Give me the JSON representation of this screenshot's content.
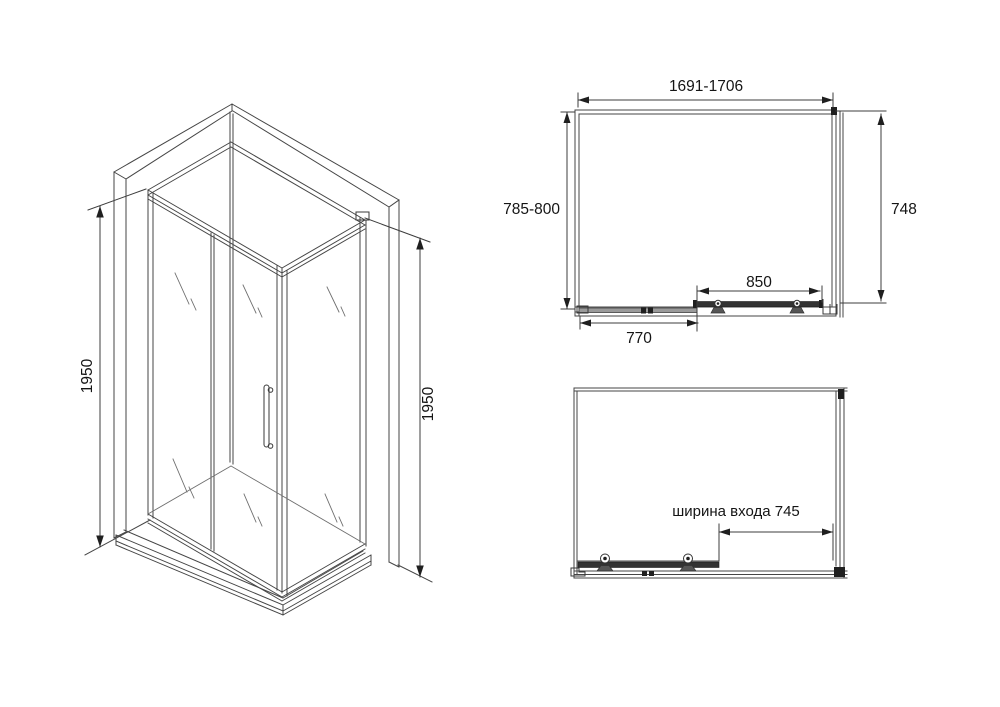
{
  "page": {
    "description": "Technical line drawing of a corner shower enclosure with sliding door: isometric view on the left, plan (top) view at upper right, front elevation at lower right",
    "background": "#ffffff"
  },
  "colors": {
    "line": "#454545",
    "line_light": "#6e6e6e",
    "dimension_line": "#3c3c3c",
    "fill_dark": "#1f1f1f",
    "fill_gray": "#9a9a9a",
    "text": "#151515",
    "background": "#ffffff"
  },
  "iso_view": {
    "label_height_left": "1950",
    "label_height_right": "1950"
  },
  "top_view": {
    "label_width_range": "1691-1706",
    "label_depth_range": "785-800",
    "label_side_panel_depth": "748",
    "label_door_width": "850",
    "label_fixed_panel_width": "770"
  },
  "front_view": {
    "label_entrance_width": "ширина входа 745"
  }
}
